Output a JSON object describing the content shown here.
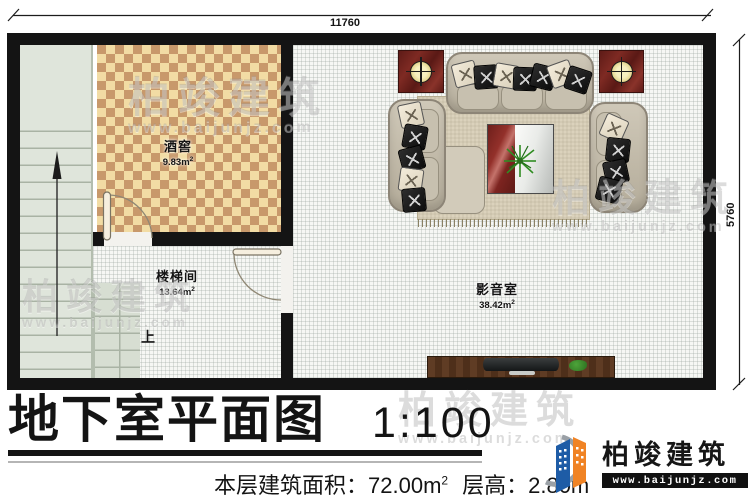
{
  "dims": {
    "top": "11760",
    "right": "5760"
  },
  "rooms": {
    "cellar": {
      "name": "酒窖",
      "area": "9.83m",
      "sup": "2"
    },
    "stairwell": {
      "name": "楼梯间",
      "area": "13.64m",
      "sup": "2"
    },
    "media": {
      "name": "影音室",
      "area": "38.42m",
      "sup": "2"
    }
  },
  "stairs": {
    "up_label": "上"
  },
  "title": {
    "text": "地下室平面图",
    "scale": "1:100"
  },
  "info": {
    "area_label": "本层建筑面积：",
    "area_value": "72.00m",
    "area_sup": "2",
    "height_label": "层高：",
    "height_value": "2.80m"
  },
  "brand": {
    "name": "柏竣建筑",
    "url": "www.baijunjz.com"
  },
  "colors": {
    "wall": "#141414",
    "cellar_light": "#f2dca4",
    "cellar_dark": "#c8996b",
    "stair_floor": "#dfe5db",
    "accent_red": "#7d2622",
    "brand_blue": "#1e5ca6",
    "brand_orange": "#f08324"
  }
}
